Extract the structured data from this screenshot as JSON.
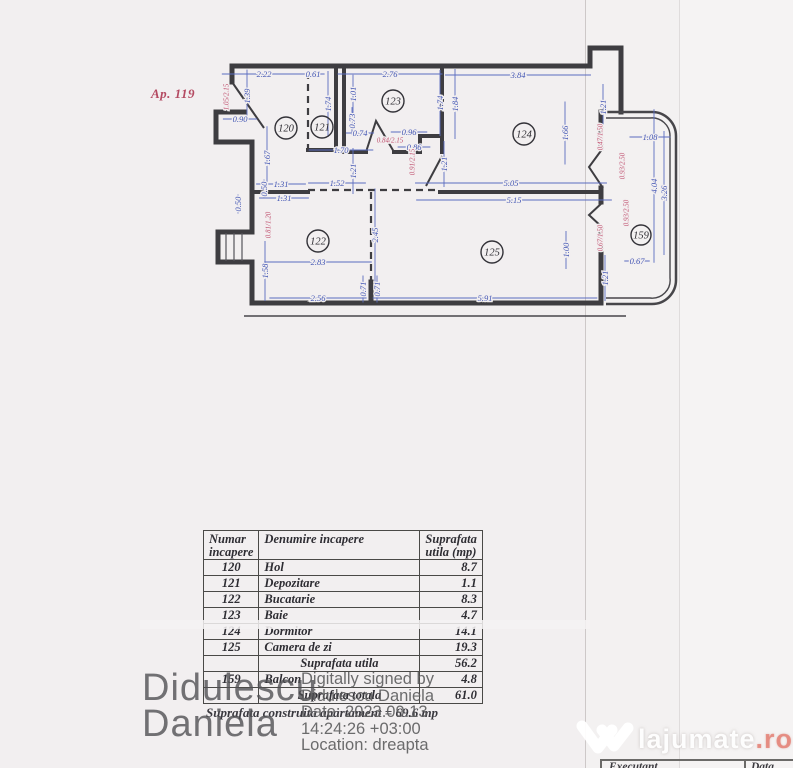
{
  "apartment_label": "Ap. 119",
  "plan": {
    "colors": {
      "wall": "#3e3d41",
      "dim_blue": "#4356b4",
      "dim_red": "#c0506e"
    },
    "rooms": [
      {
        "num": "120",
        "x": 286,
        "y": 128
      },
      {
        "num": "121",
        "x": 322,
        "y": 127
      },
      {
        "num": "123",
        "x": 393,
        "y": 101
      },
      {
        "num": "124",
        "x": 524,
        "y": 134
      },
      {
        "num": "122",
        "x": 318,
        "y": 241
      },
      {
        "num": "125",
        "x": 492,
        "y": 252
      },
      {
        "num": "159",
        "x": 641,
        "y": 235
      }
    ],
    "dims_blue": [
      [
        "2.22",
        264,
        74,
        0
      ],
      [
        "0.61",
        313,
        74,
        0
      ],
      [
        "2.76",
        390,
        74,
        0
      ],
      [
        "3.84",
        518,
        75,
        0
      ],
      [
        "1.39",
        247,
        96,
        1
      ],
      [
        "0.90",
        240,
        119,
        0
      ],
      [
        "1.67",
        267,
        158,
        1
      ],
      [
        "1.74",
        328,
        104,
        1
      ],
      [
        "1.01",
        353,
        94,
        1
      ],
      [
        "0.73",
        352,
        121,
        1
      ],
      [
        "0.74",
        360,
        133,
        0
      ],
      [
        "0.96",
        409,
        132,
        0
      ],
      [
        "0.86",
        414,
        147,
        0
      ],
      [
        "1.70",
        341,
        150,
        0
      ],
      [
        "1.21",
        353,
        171,
        1
      ],
      [
        "1.21",
        444,
        164,
        1
      ],
      [
        "1.74",
        440,
        103,
        1
      ],
      [
        "1.84",
        455,
        104,
        1
      ],
      [
        "1.66",
        565,
        133,
        1
      ],
      [
        "5.05",
        511,
        183,
        0
      ],
      [
        "5.15",
        514,
        200,
        0
      ],
      [
        "1.31",
        281,
        184,
        0
      ],
      [
        "1.52",
        337,
        183,
        0
      ],
      [
        "1.31",
        284,
        198,
        0
      ],
      [
        "0.50",
        264,
        189,
        1
      ],
      [
        "0.50",
        238,
        204,
        1
      ],
      [
        "2.83",
        318,
        262,
        0
      ],
      [
        "2.45",
        375,
        235,
        1
      ],
      [
        "1.58",
        265,
        271,
        1
      ],
      [
        "2.56",
        318,
        298,
        0
      ],
      [
        "0.71",
        363,
        289,
        1
      ],
      [
        "0.71",
        377,
        289,
        1
      ],
      [
        "5.91",
        485,
        298,
        0
      ],
      [
        "1.00",
        566,
        250,
        1
      ],
      [
        "1.21",
        605,
        278,
        1
      ],
      [
        "0.67",
        637,
        261,
        0
      ],
      [
        "1.08",
        650,
        137,
        0
      ],
      [
        "1.21",
        603,
        107,
        1
      ],
      [
        "4.04",
        654,
        186,
        1
      ],
      [
        "3.26",
        664,
        193,
        1
      ]
    ],
    "dims_red": [
      [
        "1.05/2.15",
        226,
        97,
        1
      ],
      [
        "0.84/2.15",
        390,
        140,
        0
      ],
      [
        "0.91/2.15",
        412,
        162,
        1
      ],
      [
        "0.81/1.20",
        268,
        225,
        1
      ],
      [
        "0.47/1.50",
        600,
        137,
        1
      ],
      [
        "0.93/2.50",
        622,
        166,
        1
      ],
      [
        "0.93/2.50",
        626,
        213,
        1
      ],
      [
        "0.67/1.50",
        600,
        238,
        1
      ]
    ]
  },
  "table": {
    "headers": {
      "num": "Numar incapere",
      "name": "Denumire incapere",
      "area": "Suprafata utila (mp)"
    },
    "rows": [
      {
        "num": "120",
        "name": "Hol",
        "area": "8.7",
        "summary": false
      },
      {
        "num": "121",
        "name": "Depozitare",
        "area": "1.1",
        "summary": false
      },
      {
        "num": "122",
        "name": "Bucatarie",
        "area": "8.3",
        "summary": false
      },
      {
        "num": "123",
        "name": "Baie",
        "area": "4.7",
        "summary": false
      },
      {
        "num": "124",
        "name": "Dormitor",
        "area": "14.1",
        "summary": false
      },
      {
        "num": "125",
        "name": "Camera de zi",
        "area": "19.3",
        "summary": false
      },
      {
        "num": "",
        "name": "Suprafata utila",
        "area": "56.2",
        "summary": true
      },
      {
        "num": "159",
        "name": "Balcon",
        "area": "4.8",
        "summary": false
      },
      {
        "num": "",
        "name": "Suprafata totala",
        "area": "61.0",
        "summary": true
      }
    ],
    "footnote": "Suprafata construita apartament = 69.6 mp"
  },
  "signature": {
    "stamp_line1": "Didulescu",
    "stamp_line2": "Daniela",
    "digital_lines": [
      "Digitally signed by",
      "Didulescu Daniela",
      "Date: 2023.09.13",
      "14:24:26 +03:00",
      "Location: dreapta"
    ]
  },
  "watermark": {
    "brand": "lajumate",
    "tld": ".ro",
    "accent": "#e4695a"
  },
  "footer": {
    "executant": "Executant",
    "data": "Data"
  }
}
